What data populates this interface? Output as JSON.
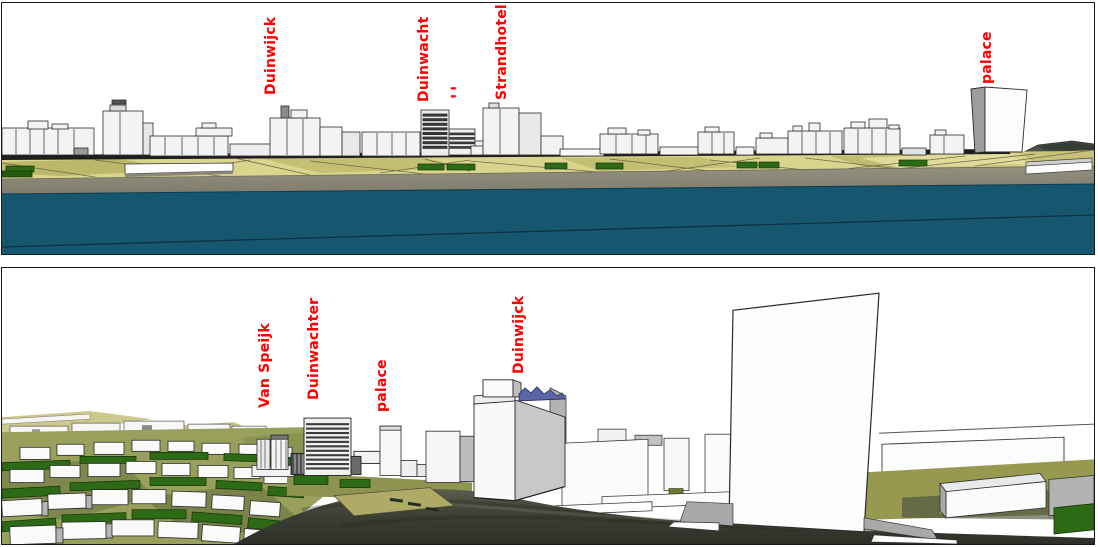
{
  "page": {
    "description": "Two 3D massing-model views of a seafront town with red building labels",
    "top_panel_view": "seafront elevation view",
    "bottom_panel_view": "street-level perspective view"
  },
  "top_panel": {
    "labels": [
      {
        "id": "duinwijck",
        "text": "Duinwijck"
      },
      {
        "id": "duinwacht",
        "text": "Duinwacht"
      },
      {
        "id": "duinwacht-dashes",
        "text": "-\n-"
      },
      {
        "id": "strandhotel",
        "text": "Strandhotel"
      },
      {
        "id": "palace",
        "text": "palace"
      }
    ]
  },
  "bottom_panel": {
    "labels": [
      {
        "id": "van-speijk",
        "text": "Van Speijk"
      },
      {
        "id": "duinwachter",
        "text": "Duinwachter"
      },
      {
        "id": "palace",
        "text": "palace"
      },
      {
        "id": "duinwijck",
        "text": "Duinwijck"
      }
    ]
  },
  "colors": {
    "label_red": "#ff0000",
    "water": "#16576f",
    "beach_grey": "#8b8778",
    "dune_grass_light": "#d9d58d",
    "dune_grass_dark": "#b7b164",
    "hedge_green": "#2d6a16",
    "terrain_olive": "#98a05c",
    "road_dark": "#31352b",
    "building_white": "#f5f5f5",
    "building_grey": "#b9b9b9",
    "roof_blue": "#5a66a8",
    "panel_border": "#1a1a1a"
  }
}
